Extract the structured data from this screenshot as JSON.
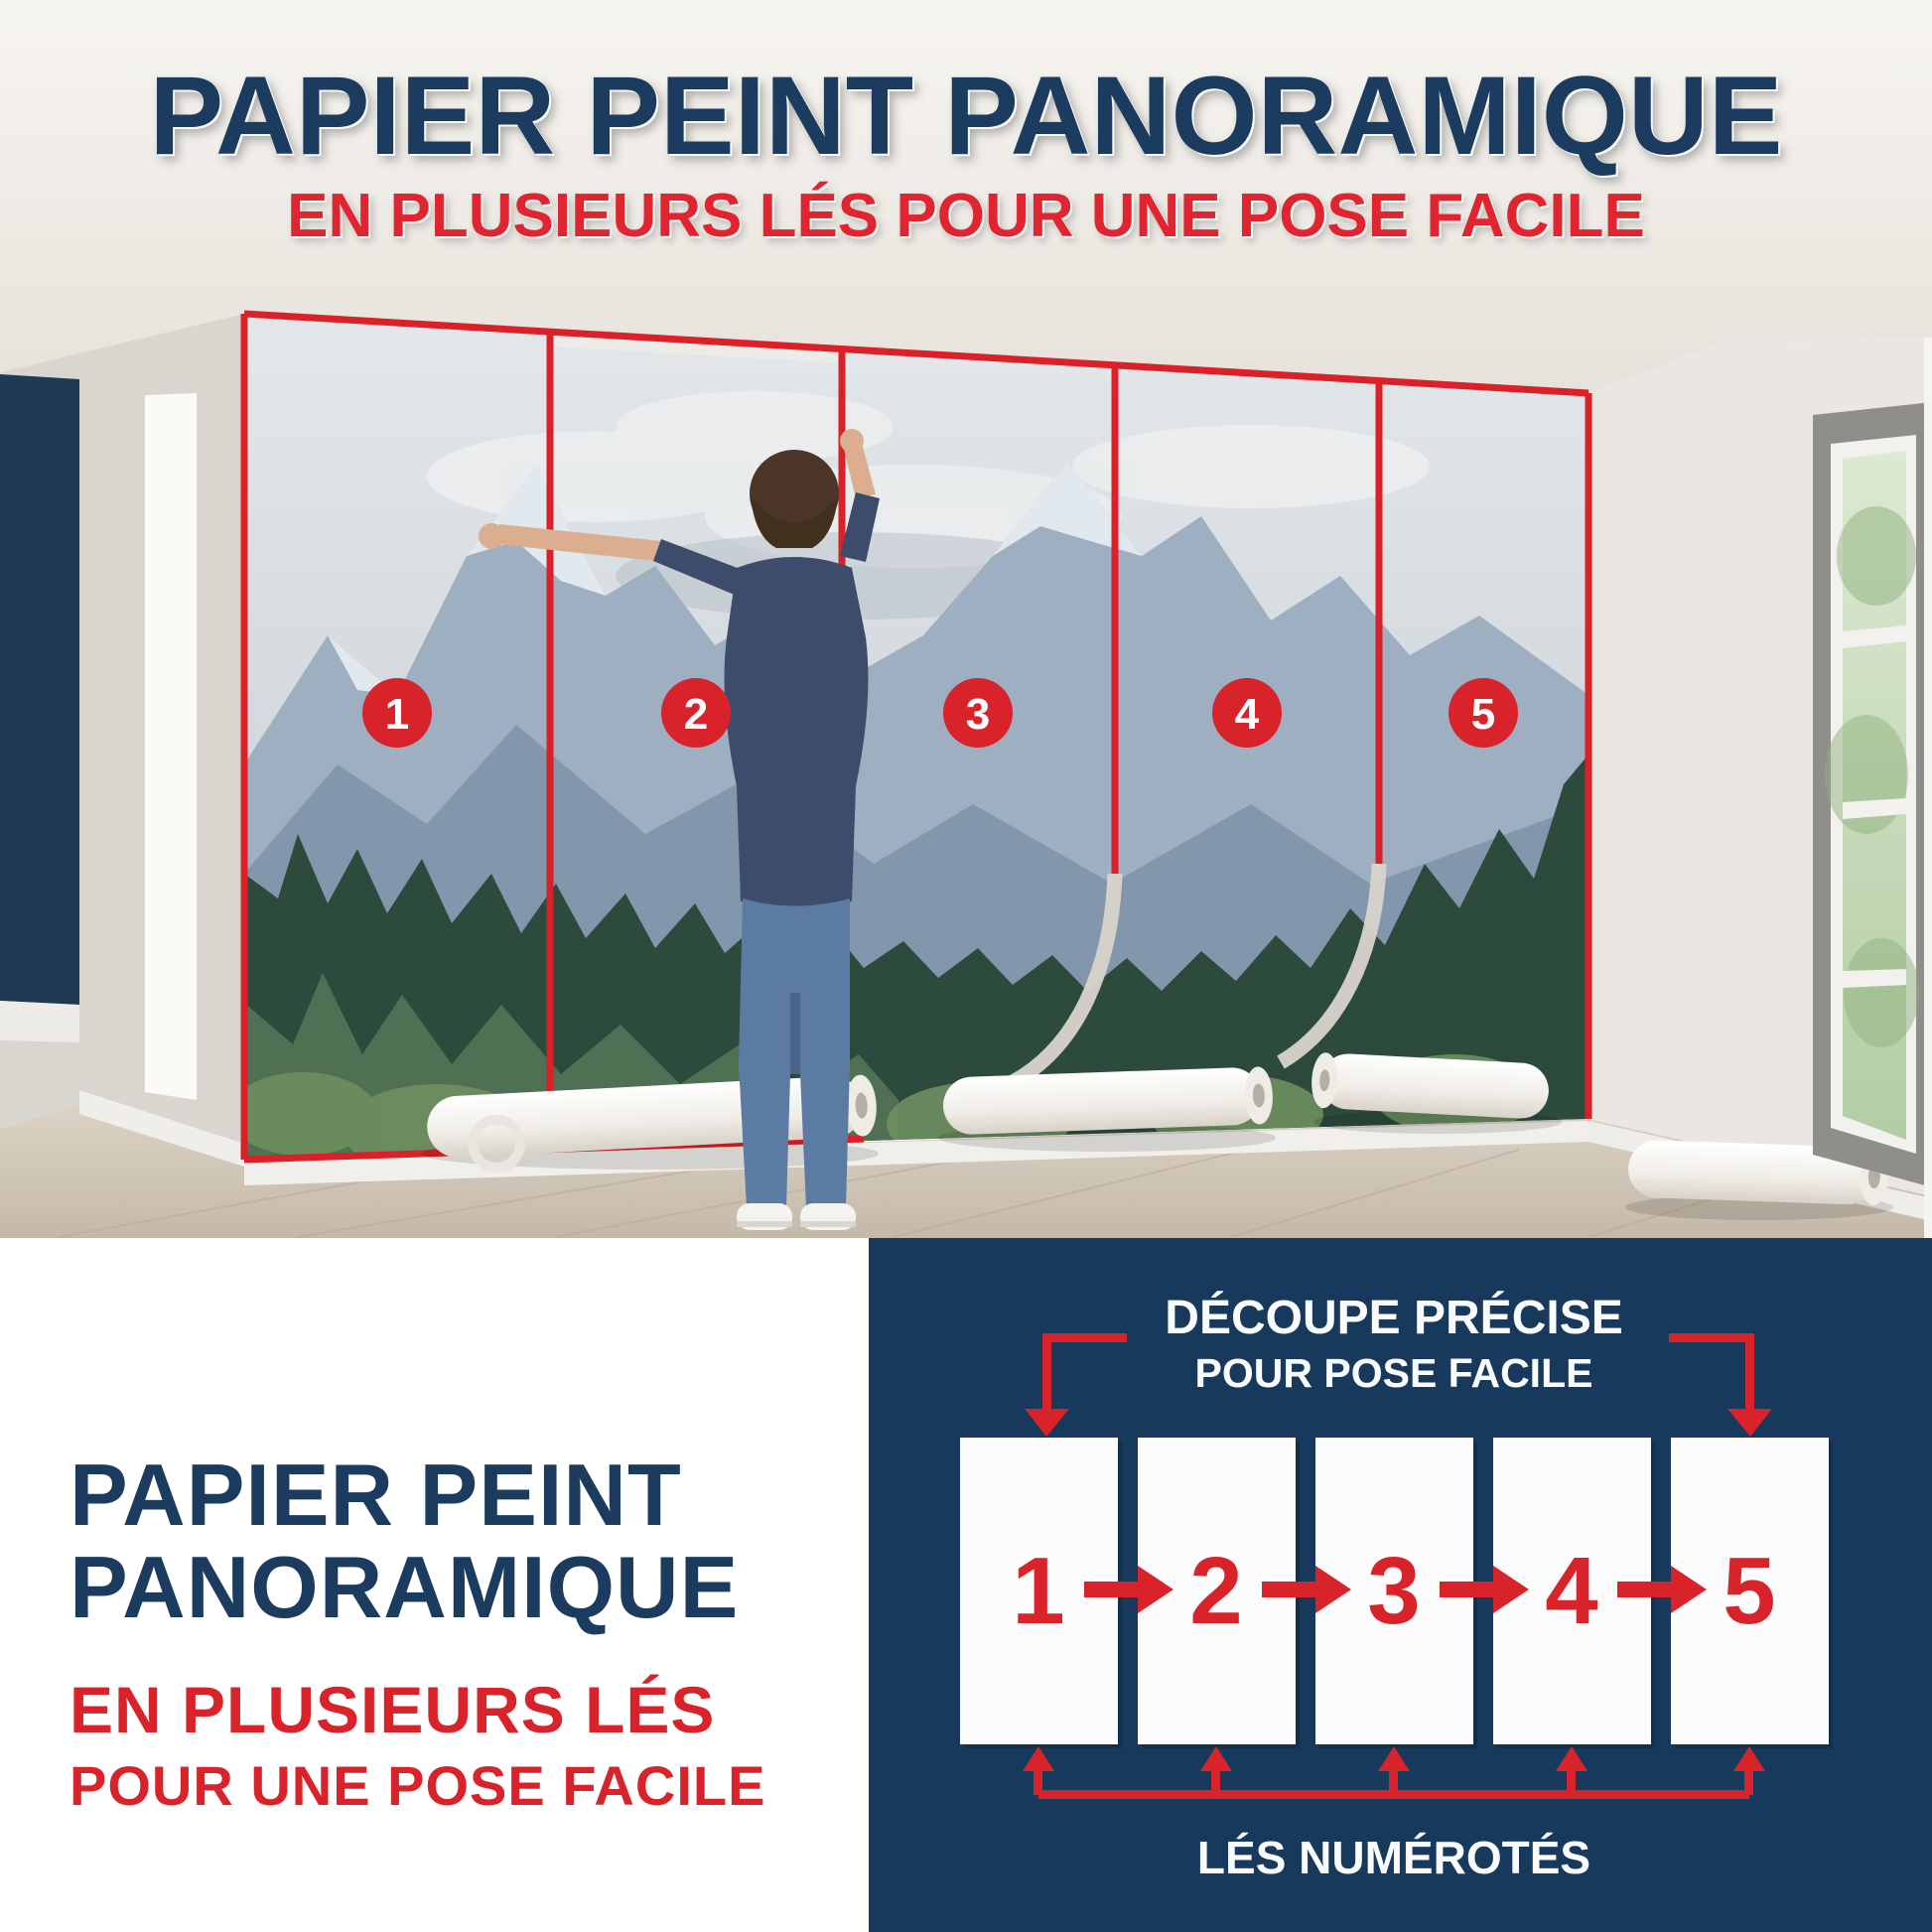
{
  "colors": {
    "navy_text": "#1b3c5e",
    "panel_navy": "#17395b",
    "accent_red": "#da2129",
    "subtitle_red": "#e02531",
    "accent_wall_navy": "#1f3a55",
    "white": "#ffffff"
  },
  "header": {
    "title": "PAPIER PEINT PANORAMIQUE",
    "subtitle": "EN PLUSIEURS LÉS POUR UNE POSE FACILE"
  },
  "photo": {
    "description": "man-installing-panoramic-mountain-forest-wall-mural-in-5-numbered-strips",
    "strip_labels": [
      "1",
      "2",
      "3",
      "4",
      "5"
    ]
  },
  "bottom_left": {
    "title_line1": "PAPIER PEINT",
    "title_line2": "PANORAMIQUE",
    "subtitle_line1": "EN PLUSIEURS LÉS",
    "subtitle_line2": "POUR UNE POSE FACILE"
  },
  "diagram": {
    "header_line1": "DÉCOUPE PRÉCISE",
    "header_line2": "POUR POSE FACILE",
    "strip_numbers": [
      "1",
      "2",
      "3",
      "4",
      "5"
    ],
    "caption": "LÉS NUMÉROTÉS"
  }
}
